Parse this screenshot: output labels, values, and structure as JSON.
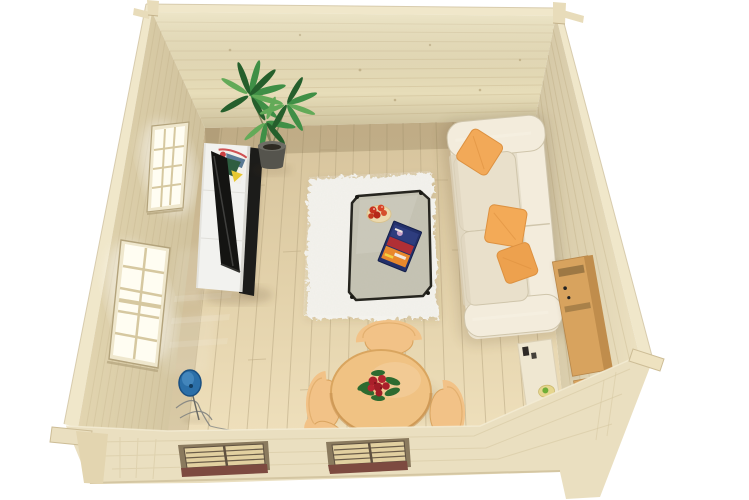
{
  "scene": {
    "description": "3D bird's-eye rendering of a square log cabin interior (garden room) with no roof, white background",
    "items": [
      "log-cabin-shell",
      "back-wall",
      "left-wall-with-two-windows",
      "right-wall",
      "wood-plank-floor",
      "white-shag-rug",
      "glass-coffee-table",
      "fruit-plate",
      "magazine",
      "cream-sofa",
      "orange-pillows",
      "flatscreen-tv",
      "white-tv-sideboard",
      "abstract-artwork",
      "potted-palm-plant",
      "round-dining-table",
      "wooden-chairs",
      "red-flower-centerpiece",
      "oak-shelving-unit",
      "side-table-with-snacks",
      "blue-floor-lamp",
      "dark-media-object",
      "front-wall-with-two-windows"
    ]
  },
  "colors": {
    "background": "#ffffff",
    "wall_back": "#e7ddb9",
    "wall_left": "#e2d5b0",
    "wall_right": "#ece1c1",
    "wall_rim": "#f0e7ca",
    "wall_corner_post": "#e8dcba",
    "wall_seam": "#d2c29b",
    "floor_plank_line": "#b9a883",
    "rug": "#f3f2ed",
    "rug_speckle": "#d8d6cd",
    "window_frame": "#efe7cd",
    "window_pane": "#fffdf2",
    "window_bar": "#d6c8a0",
    "window_edge": "#b3a37c",
    "band_wood": "#eadfc0",
    "band_line": "#d5c7a0",
    "band_window_recess": "#8a7a5e",
    "band_window_grid": "#e2d0a0",
    "band_window_dark": "#5f5140",
    "band_sill": "#7d4a40",
    "tv_cabinet": "#f2f2ef",
    "tv_screen": "#141412",
    "tv_panel": "#1c1c1a",
    "art_red": "#cc4043",
    "art_green": "#2e5d40",
    "art_yellow": "#e8c832",
    "art_blue": "#5a7a95",
    "art_white": "#f2f0ea",
    "plant_leaf_dark": "#255f2c",
    "plant_leaf": "#3f8f46",
    "plant_leaf_light": "#63aa58",
    "plant_pot": "#55544d",
    "plant_pot_rim": "#6e6d65",
    "sofa_body": "#ece4d1",
    "sofa_cushion": "#e9e0cb",
    "sofa_light": "#f3ecdc",
    "sofa_seam": "#cfc5ab",
    "pillow_orange": "#f2a958",
    "pillow_orange_dark": "#dd9140",
    "table_glass": "#8f8a6e",
    "table_frame": "#26251f",
    "plate": "#ecd9ad",
    "fruit_red": "#c62b1e",
    "mag_navy": "#23306b",
    "mag_orange": "#e8882c",
    "mag_red": "#c03030",
    "mag_white": "#f0e8e0",
    "dining_table": "#f0c283",
    "dining_table_edge": "#d9a55f",
    "chair_wood": "#f2c287",
    "chair_shadow": "#d9a45f",
    "flower_red": "#aa1f2a",
    "flower_leaf": "#2e6b30",
    "shelf_oak": "#d8a35e",
    "shelf_oak_side": "#c08d4c",
    "shelf_slot": "#8a6a3c",
    "desk": "#efe7d1",
    "food_plate": "#e6d68e",
    "food_green": "#6fae38",
    "dark_object": "#3b332c",
    "lamp_blue": "#2b6fa8",
    "lamp_blue_dark": "#1a4f80",
    "shadow": "rgba(90,70,40,0.35)"
  }
}
